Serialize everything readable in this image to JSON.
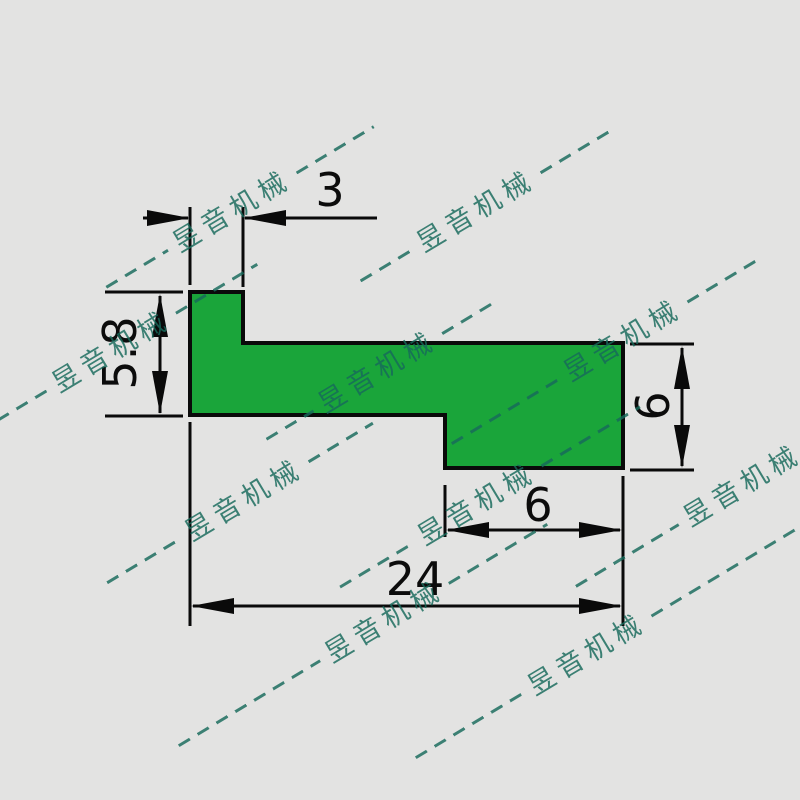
{
  "app": {
    "background_color": "#e3e3e2"
  },
  "drawing": {
    "type": "profile-cross-section",
    "shape_fill": "#1aa53a",
    "outline_color": "#0a0a0a",
    "dimensions": {
      "top_width": "3",
      "left_height": "5.8",
      "right_height": "6",
      "bottom_step_width": "6",
      "total_width": "24"
    }
  },
  "watermark": {
    "text": "昱音机械",
    "color": "#176a5b",
    "angle_deg": -31,
    "style": "dashed-line"
  }
}
